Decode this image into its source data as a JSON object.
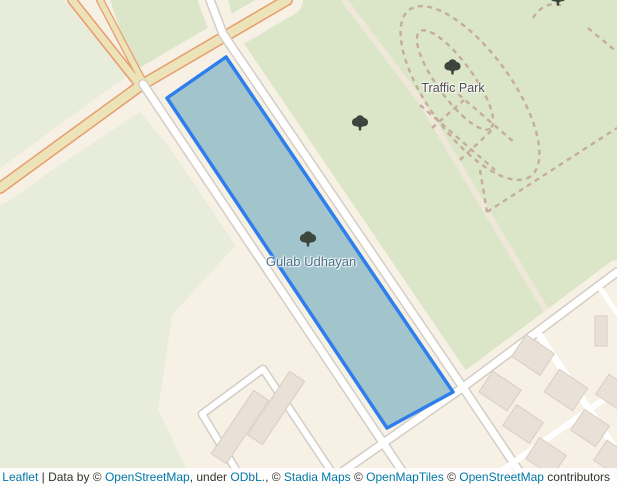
{
  "map": {
    "labels": {
      "traffic_park": "Traffic Park",
      "gulab_udhayan": "Gulab Udhayan"
    },
    "icons": {
      "tree": "tree-icon"
    },
    "colors": {
      "background": "#f6f0e5",
      "park_green": "#dbe6c9",
      "field_green": "#e8ecda",
      "road_yellow": "#ece3b8",
      "road_yellow_casing": "#e89c6c",
      "road_white": "#ffffff",
      "road_casing": "#d2cec6",
      "pale_path": "#efe8da",
      "dashed_path": "#c4ad99",
      "building_fill": "#e9e1d8",
      "building_stroke": "#d8cec2",
      "polygon_fill": "#a2c4cd",
      "polygon_stroke": "#2e7eec",
      "tree_color": "#3c463c",
      "label_gray": "#4d4d4d",
      "label_park_blue": "#4a7086",
      "link_blue": "#0078a8"
    }
  },
  "attribution": {
    "leaflet_link": "Leaflet",
    "separator": " | ",
    "data_by": "Data by © ",
    "osm_link_1": "OpenStreetMap",
    "under": ", under ",
    "odbl_link": "ODbL.",
    "comma_c": ", © ",
    "stadia_link": "Stadia Maps",
    "c2": " © ",
    "openmaptiles_link": "OpenMapTiles",
    "c3": " © ",
    "osm_link_2": "OpenStreetMap",
    "contributors": " contributors"
  }
}
